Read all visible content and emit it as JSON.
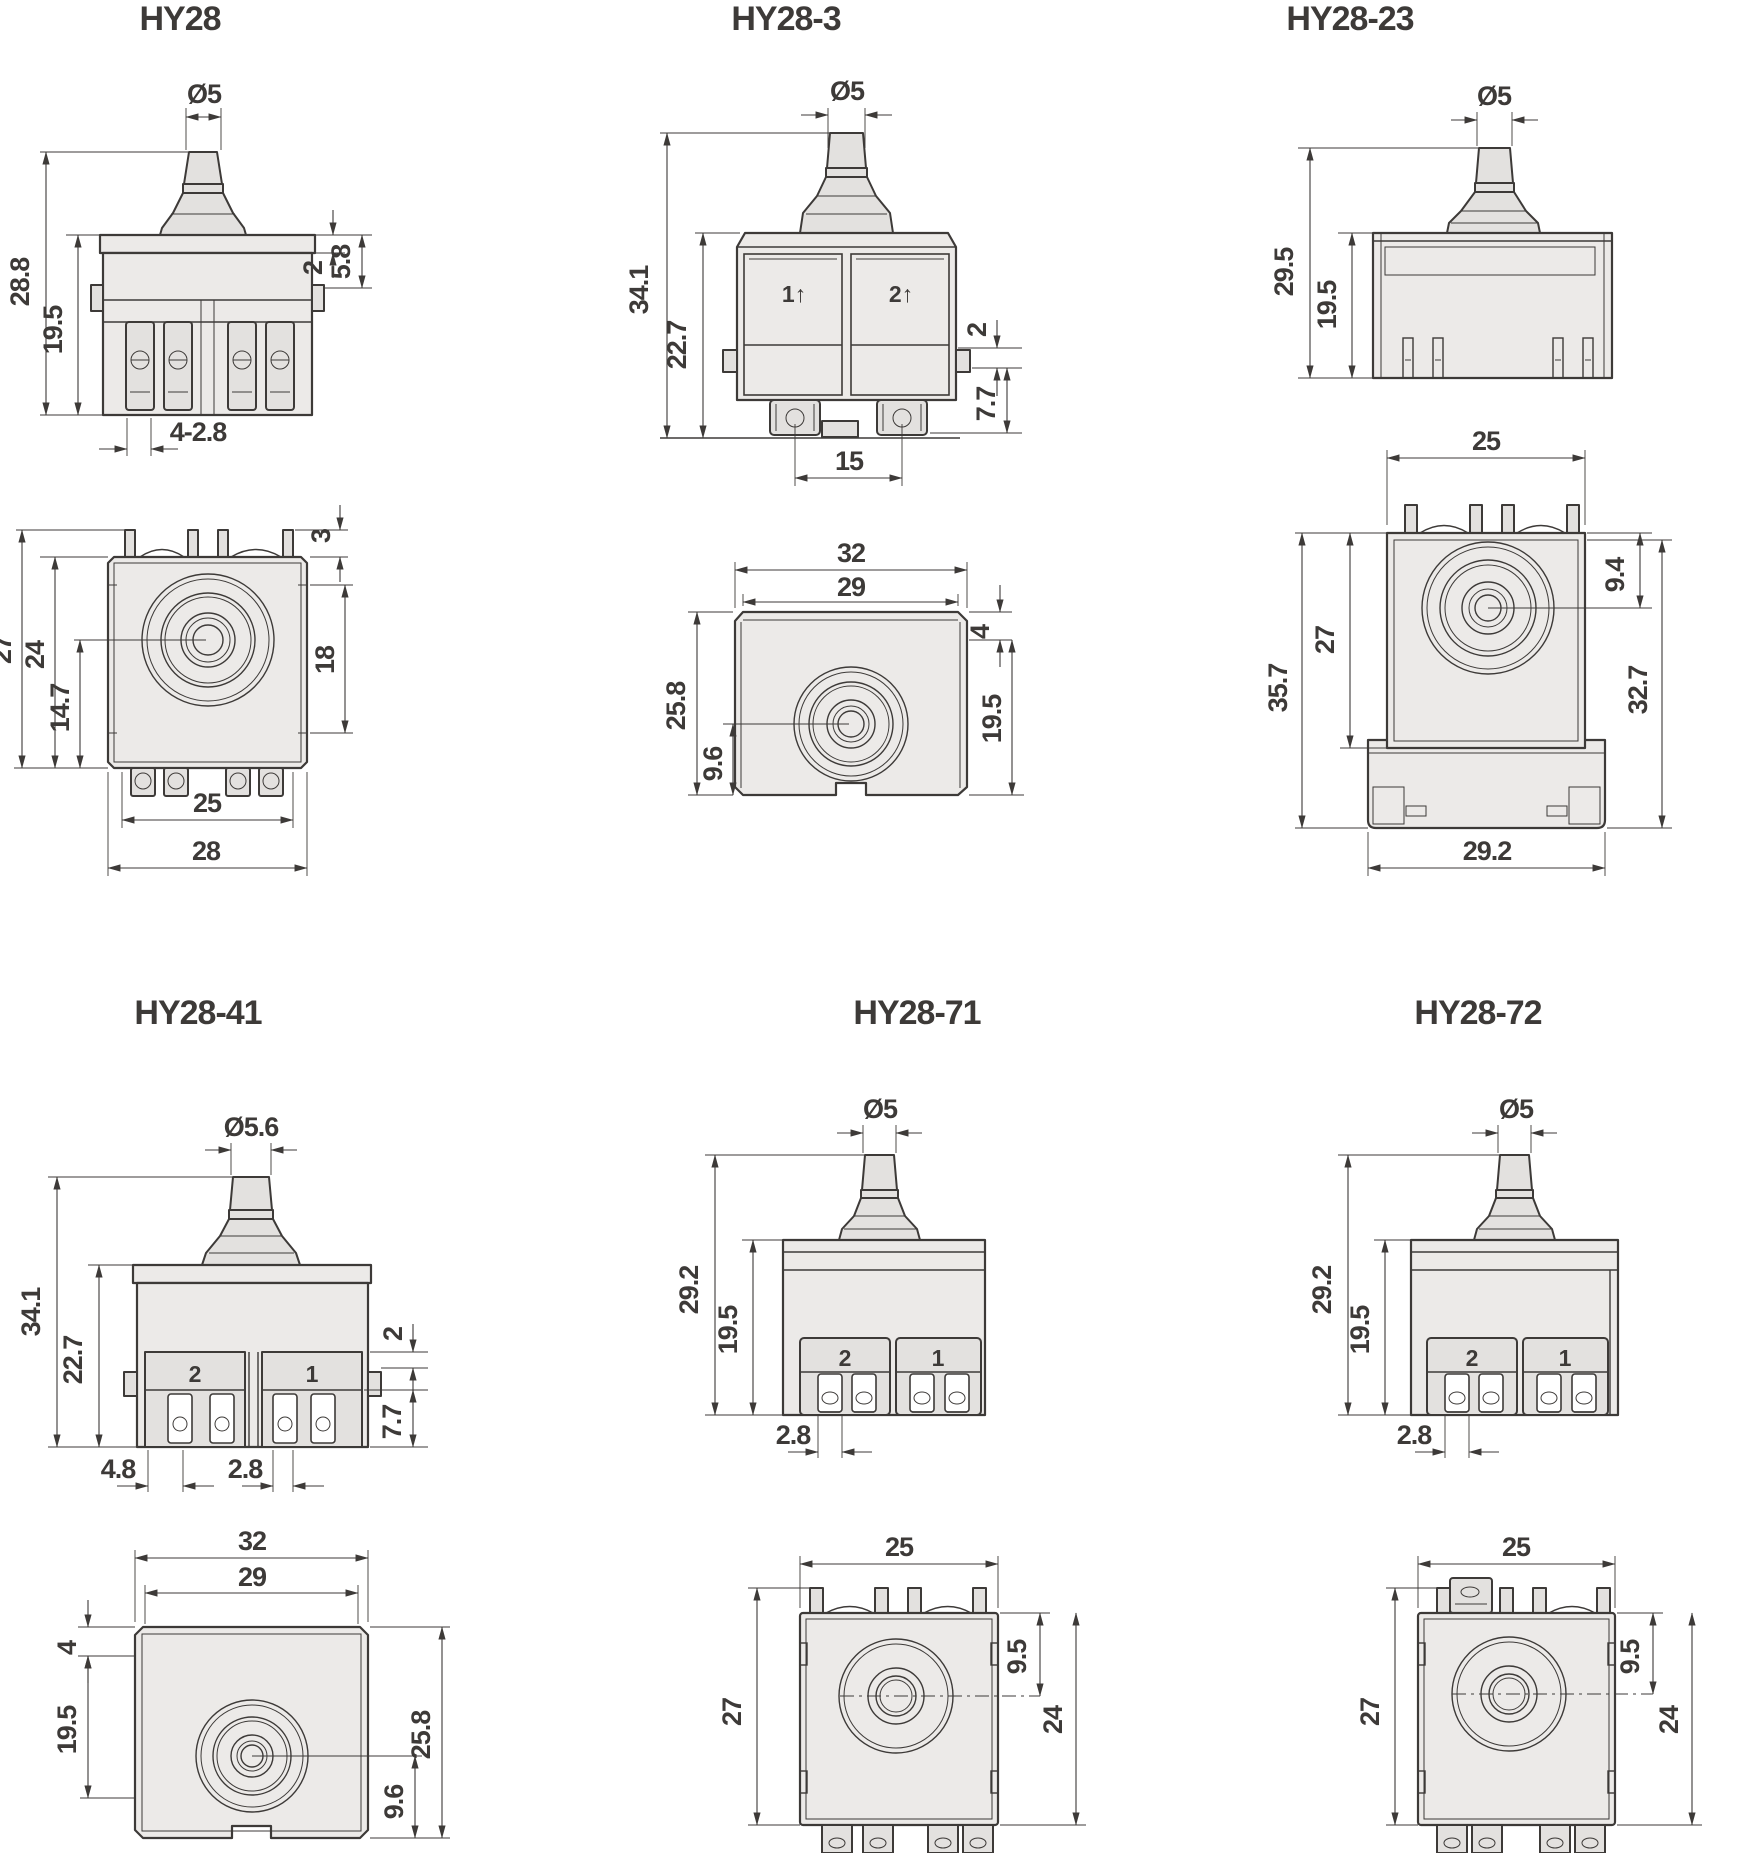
{
  "document": {
    "type": "technical-dimension-drawing",
    "series": "HY28 trigger switches",
    "units_note": "mm",
    "colors": {
      "line": "#3d3a38",
      "fill_light": "#eceae8",
      "fill_mid": "#e3e1df",
      "background": "#ffffff"
    }
  },
  "p1": {
    "title": "HY28",
    "dia": "Ø5",
    "d1": "28.8",
    "d2": "19.5",
    "d3": "2",
    "d4": "5.8",
    "d5": "4-2.8",
    "d6": "3",
    "d7": "27",
    "d8": "24",
    "d9": "14.7",
    "d10": "18",
    "d11": "25",
    "d12": "28"
  },
  "p2": {
    "title": "HY28-3",
    "dia": "Ø5",
    "m1": "1↑",
    "m2": "2↑",
    "d1": "34.1",
    "d2": "22.7",
    "d3": "2",
    "d4": "7.7",
    "d5": "15",
    "d6": "32",
    "d7": "29",
    "d8": "4",
    "d9": "19.5",
    "d10": "25.8",
    "d11": "9.6"
  },
  "p3": {
    "title": "HY28-23",
    "dia": "Ø5",
    "d1": "29.5",
    "d2": "19.5",
    "d3": "25",
    "d4": "9.4",
    "d5": "35.7",
    "d6": "27",
    "d7": "32.7",
    "d8": "29.2"
  },
  "p4": {
    "title": "HY28-41",
    "dia": "Ø5.6",
    "m1": "2",
    "m2": "1",
    "d1": "34.1",
    "d2": "22.7",
    "d3": "2",
    "d4": "7.7",
    "d5": "4.8",
    "d6": "2.8",
    "d7": "32",
    "d8": "29",
    "d9": "4",
    "d10": "19.5",
    "d11": "25.8",
    "d12": "9.6"
  },
  "p5": {
    "title": "HY28-71",
    "dia": "Ø5",
    "m1": "2",
    "m2": "1",
    "d1": "29.2",
    "d2": "19.5",
    "d3": "2.8",
    "d4": "25",
    "d5": "9.5",
    "d6": "24",
    "d7": "27"
  },
  "p6": {
    "title": "HY28-72",
    "dia": "Ø5",
    "m1": "2",
    "m2": "1",
    "d1": "29.2",
    "d2": "19.5",
    "d3": "2.8",
    "d4": "25",
    "d5": "9.5",
    "d6": "24",
    "d7": "27"
  }
}
